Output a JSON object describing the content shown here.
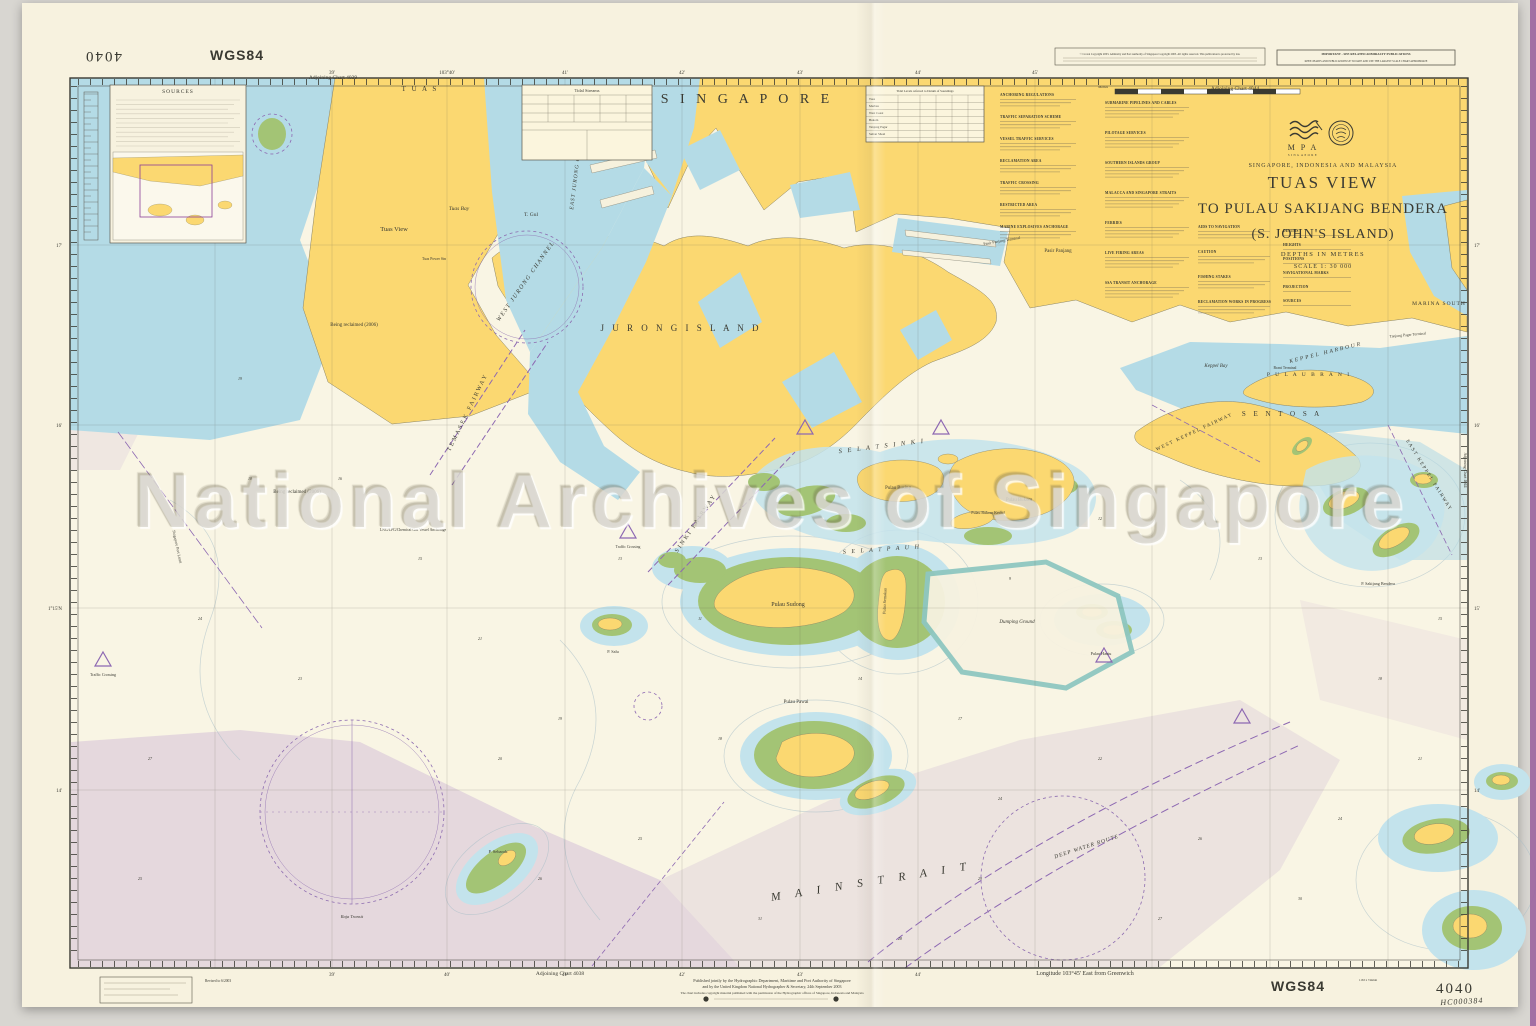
{
  "watermark": "National Archives of Singapore",
  "colors": {
    "paper": "#f7f2df",
    "sea": "#f9f5e4",
    "land_yellow": "#fbd871",
    "shallow_blue": "#b4dbe6",
    "halo_blue": "#c3e3ec",
    "reef_green": "#a3c475",
    "restricted_lavender": "#cdb6d4",
    "magenta": "#8d68b2",
    "wgs_purple": "#8d3f98",
    "ink": "#3a3a32",
    "lagoon_rim": "#8fc7c0"
  },
  "chart": {
    "number": "4040",
    "datum_label": "WGS84",
    "archive_ref": "HC000384",
    "dimensions_note": "1163 x 744mm",
    "adjoining_top_left": "Adjoining Chart 4039",
    "adjoining_top_right": "Adjoining Chart 4044",
    "adjoining_right": "Adjoining Chart 4044",
    "adjoining_bottom_left": "Adjoining Chart 4038",
    "longitude_note": "Longitude 103°45' East from Greenwich",
    "revision_note": "Revised to 6/2003",
    "title_block": {
      "mpa": "M P A",
      "mpa_sub": "SINGAPORE",
      "region": "SINGAPORE, INDONESIA AND MALAYSIA",
      "title1": "TUAS VIEW",
      "title2": "TO PULAU SAKIJANG BENDERA",
      "title3": "(S. JOHN'S ISLAND)",
      "depths": "DEPTHS  IN  METRES",
      "scale": "SCALE  1: 30 000"
    },
    "notices": {
      "copyright": "© Crown Copyright 2003. Admiralty and Port Authority of Singapore Copyright 2003. All rights reserved. This publication is protected by law.",
      "important_title": "IMPORTANT - SEE RELATED ADMIRALTY PUBLICATIONS",
      "important_body": "KEEP CHARTS AND PUBLICATIONS UP TO DATE AND USE THE LARGEST SCALE CHART APPROPRIATE"
    },
    "publication": {
      "line1": "Published jointly by the Hydrographic Department, Maritime and Port Authority of Singapore",
      "line2": "and by the United Kingdom National Hydrographer & Secretary, 24th September 2003",
      "line3": "The chart includes copyright material published with the permission of the Hydrographic offices of Singapore, Indonesia and Malaysia"
    },
    "panels": {
      "sources_title": "SOURCES",
      "tidal_streams_title": "Tidal Streams",
      "tidal_levels_title": "Tidal Levels referred to Datum of Soundings",
      "metres_scale_label": "Metres",
      "tidal_stations": [
        "Tuas",
        "Merbau",
        "West Coast",
        "Bukom",
        "Tanjong Pagar",
        "Sultan Shoal"
      ]
    },
    "grid": {
      "top": [
        [
          332,
          "39'"
        ],
        [
          447,
          "103°40'"
        ],
        [
          565,
          "41'"
        ],
        [
          682,
          "42'"
        ],
        [
          800,
          "43'"
        ],
        [
          918,
          "44'"
        ],
        [
          1035,
          "45'"
        ]
      ],
      "bottom": [
        [
          332,
          "39'"
        ],
        [
          447,
          "40'"
        ],
        [
          565,
          "41'"
        ],
        [
          682,
          "42'"
        ],
        [
          800,
          "43'"
        ],
        [
          918,
          "44'"
        ]
      ],
      "left": [
        [
          245,
          "17'"
        ],
        [
          425,
          "16'"
        ],
        [
          608,
          "1°15'N"
        ],
        [
          790,
          "14'"
        ]
      ],
      "right": [
        [
          245,
          "17'"
        ],
        [
          425,
          "16'"
        ],
        [
          608,
          "15'"
        ],
        [
          790,
          "14'"
        ]
      ]
    }
  },
  "notes": {
    "columns": [
      {
        "x": 1000,
        "w": 76,
        "y": 96,
        "gap": 22,
        "nlines": 3,
        "titles": [
          "ANCHORING REGULATIONS",
          "TRAFFIC SEPARATION SCHEME",
          "VESSEL TRAFFIC SERVICES",
          "RECLAMATION AREA",
          "TRAFFIC CROSSING",
          "RESTRICTED AREA",
          "MARINE EXPLOSIVES ANCHORAGE"
        ]
      },
      {
        "x": 1105,
        "w": 84,
        "y": 104,
        "gap": 30,
        "nlines": 4,
        "titles": [
          "SUBMARINE PIPELINES AND CABLES",
          "PILOTAGE SERVICES",
          "SOUTHERN ISLANDS GROUP",
          "MALACCA AND SINGAPORE STRAITS",
          "FERRIES",
          "LIVE FIRING AREAS",
          "SSA TRANSIT ANCHORAGE"
        ]
      },
      {
        "x": 1198,
        "w": 72,
        "y": 228,
        "gap": 25,
        "nlines": 3,
        "titles": [
          "AIDS TO NAVIGATION",
          "CAUTION",
          "FISHING STAKES",
          "RECLAMATION WORKS IN PROGRESS"
        ]
      },
      {
        "x": 1283,
        "w": 84,
        "y": 232,
        "gap": 14,
        "nlines": 1,
        "titles": [
          "DEPTHS",
          "HEIGHTS",
          "POSITIONS",
          "NAVIGATIONAL MARKS",
          "PROJECTION",
          "SOURCES"
        ]
      }
    ]
  },
  "map": {
    "labels": [
      {
        "t": "S I N G A P O R E",
        "x": 747,
        "y": 103,
        "fs": 14,
        "ls": 4
      },
      {
        "t": "T U A S",
        "x": 420,
        "y": 91,
        "fs": 7,
        "ls": 2
      },
      {
        "t": "Tuas View",
        "x": 394,
        "y": 231,
        "fs": 6.5
      },
      {
        "t": "Tuas Bay",
        "x": 459,
        "y": 210,
        "fs": 5.5,
        "i": 1
      },
      {
        "t": "T. Gul",
        "x": 531,
        "y": 216,
        "fs": 5.5
      },
      {
        "t": "WEST JURONG CHANNEL",
        "x": 527,
        "y": 282,
        "fs": 6,
        "r": -55,
        "i": 1,
        "ls": 1.5
      },
      {
        "t": "EAST JURONG CHANNEL",
        "x": 578,
        "y": 170,
        "fs": 5.5,
        "r": -83,
        "i": 1,
        "ls": 1
      },
      {
        "t": "J U R O N G   I S L A N D",
        "x": 681,
        "y": 331,
        "fs": 9,
        "ls": 3
      },
      {
        "t": "TEMASEK FAIRWAY",
        "x": 469,
        "y": 413,
        "fs": 6,
        "r": -64,
        "c": "p",
        "ls": 2
      },
      {
        "t": "SINKI FAIRWAY",
        "x": 697,
        "y": 524,
        "fs": 6,
        "r": -56,
        "c": "p",
        "ls": 2
      },
      {
        "t": "S E L A T   S I N K I",
        "x": 882,
        "y": 448,
        "fs": 6.5,
        "r": -7,
        "i": 1,
        "ls": 2
      },
      {
        "t": "S E L A T   P A U H",
        "x": 882,
        "y": 551,
        "fs": 6,
        "r": -4,
        "i": 1,
        "ls": 2
      },
      {
        "t": "Pulau Busing",
        "x": 898,
        "y": 489,
        "fs": 4.8
      },
      {
        "t": "Pulau Bukom",
        "x": 1019,
        "y": 501,
        "fs": 4.8
      },
      {
        "t": "Pulau Bukom Kechil",
        "x": 988,
        "y": 514,
        "fs": 4
      },
      {
        "t": "Pulau Sudong",
        "x": 788,
        "y": 606,
        "fs": 6
      },
      {
        "t": "Pulau Pawai",
        "x": 796,
        "y": 703,
        "fs": 5
      },
      {
        "t": "Pulau Semakau",
        "x": 886,
        "y": 601,
        "fs": 4.2,
        "r": -88
      },
      {
        "t": "Dumping Ground",
        "x": 1017,
        "y": 623,
        "fs": 5,
        "i": 1
      },
      {
        "t": "M A I N   S T R A I T",
        "x": 872,
        "y": 885,
        "fs": 11.5,
        "r": -9,
        "i": 1,
        "ls": 6
      },
      {
        "t": "DEEP WATER ROUTE",
        "x": 1087,
        "y": 848,
        "fs": 5.5,
        "r": -18,
        "c": "p",
        "i": 1,
        "ls": 1
      },
      {
        "t": "S E N T O S A",
        "x": 1282,
        "y": 416,
        "fs": 7,
        "ls": 3
      },
      {
        "t": "P U L A U   B R A N I",
        "x": 1309,
        "y": 376,
        "fs": 5.5,
        "ls": 2
      },
      {
        "t": "MARINA SOUTH",
        "x": 1439,
        "y": 305,
        "fs": 5.5,
        "ls": 1
      },
      {
        "t": "KEPPEL HARBOUR",
        "x": 1326,
        "y": 354,
        "fs": 5.5,
        "r": -14,
        "i": 1,
        "ls": 2
      },
      {
        "t": "Keppel Bay",
        "x": 1216,
        "y": 367,
        "fs": 5,
        "i": 1
      },
      {
        "t": "Brani Terminal",
        "x": 1285,
        "y": 369,
        "fs": 3.8
      },
      {
        "t": "Tanjong Pagar Terminal",
        "x": 1408,
        "y": 336,
        "fs": 3.8,
        "r": -5
      },
      {
        "t": "Pasir Panjang",
        "x": 1058,
        "y": 252,
        "fs": 5
      },
      {
        "t": "Pasir Panjang Terminal",
        "x": 1002,
        "y": 242,
        "fs": 4,
        "r": -10
      },
      {
        "t": "Being reclaimed (2006)",
        "x": 354,
        "y": 326,
        "fs": 5
      },
      {
        "t": "Being reclaimed (2006)",
        "x": 297,
        "y": 493,
        "fs": 5
      },
      {
        "t": "LNG/LPG/Chemical Gas Vessel Anchorage",
        "x": 413,
        "y": 531,
        "fs": 3.8,
        "c": "p"
      },
      {
        "t": "Singapore Port Limit",
        "x": 176,
        "y": 547,
        "fs": 4,
        "r": 78,
        "c": "p"
      },
      {
        "t": "Raja Transit",
        "x": 352,
        "y": 918,
        "fs": 4.5,
        "c": "p",
        "i": 1
      },
      {
        "t": "Tuas Power Stn",
        "x": 434,
        "y": 260,
        "fs": 3.8
      },
      {
        "t": "P. Sebarok",
        "x": 498,
        "y": 853,
        "fs": 4.5
      },
      {
        "t": "Pulau Hantu",
        "x": 1101,
        "y": 655,
        "fs": 4.2
      },
      {
        "t": "P. Salu",
        "x": 613,
        "y": 653,
        "fs": 4.2
      },
      {
        "t": "P. Sakijang Bendera",
        "x": 1378,
        "y": 585,
        "fs": 4.2
      },
      {
        "t": "WEST KEPPEL FAIRWAY",
        "x": 1195,
        "y": 433,
        "fs": 5,
        "r": -25,
        "c": "p",
        "ls": 1.5
      },
      {
        "t": "EAST KEPPEL FAIRWAY",
        "x": 1428,
        "y": 476,
        "fs": 5,
        "r": 58,
        "c": "p",
        "ls": 1.5
      },
      {
        "t": "Traffic Crossing",
        "x": 103,
        "y": 676,
        "fs": 4,
        "c": "p"
      },
      {
        "t": "Traffic Crossing",
        "x": 628,
        "y": 548,
        "fs": 3.8,
        "c": "p"
      }
    ]
  },
  "soundings": [
    [
      180,
      150,
      "22"
    ],
    [
      250,
      480,
      "18"
    ],
    [
      200,
      620,
      "24"
    ],
    [
      150,
      760,
      "27"
    ],
    [
      420,
      560,
      "15"
    ],
    [
      480,
      640,
      "21"
    ],
    [
      560,
      720,
      "19"
    ],
    [
      640,
      840,
      "25"
    ],
    [
      760,
      920,
      "31"
    ],
    [
      900,
      940,
      "28"
    ],
    [
      1000,
      800,
      "24"
    ],
    [
      1100,
      760,
      "22"
    ],
    [
      1200,
      840,
      "26"
    ],
    [
      1300,
      900,
      "30"
    ],
    [
      1380,
      680,
      "18"
    ],
    [
      1440,
      620,
      "15"
    ],
    [
      1100,
      520,
      "12"
    ],
    [
      1010,
      580,
      "9"
    ],
    [
      700,
      620,
      "11"
    ],
    [
      620,
      560,
      "13"
    ],
    [
      340,
      480,
      "16"
    ],
    [
      300,
      680,
      "23"
    ],
    [
      500,
      760,
      "20"
    ],
    [
      860,
      680,
      "14"
    ],
    [
      960,
      720,
      "17"
    ],
    [
      1260,
      560,
      "13"
    ],
    [
      1420,
      760,
      "21"
    ],
    [
      540,
      880,
      "26"
    ],
    [
      980,
      880,
      "29"
    ],
    [
      1160,
      920,
      "27"
    ],
    [
      240,
      380,
      "19"
    ],
    [
      140,
      880,
      "25"
    ],
    [
      1340,
      820,
      "24"
    ],
    [
      720,
      740,
      "18"
    ]
  ]
}
